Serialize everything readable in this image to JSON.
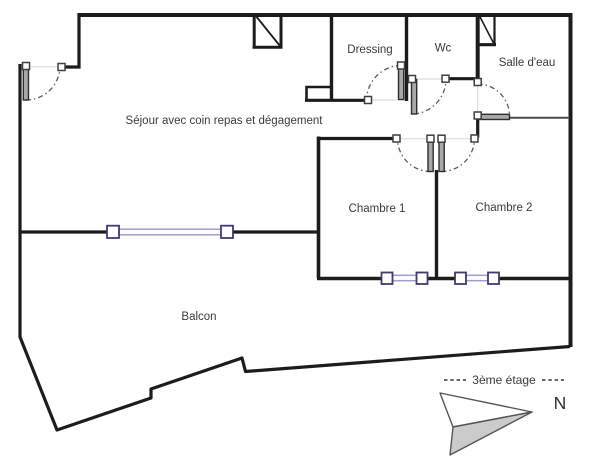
{
  "labels": {
    "sejour": "Séjour avec coin repas et dégagement",
    "dressing": "Dressing",
    "wc": "Wc",
    "salle_deau": "Salle d'eau",
    "chambre1": "Chambre 1",
    "chambre2": "Chambre 2",
    "balcon": "Balcon",
    "floor": "3ème étage",
    "north": "N"
  },
  "colors": {
    "wall": "#1c1c1c",
    "interior_thin_wall": "#4a4a4a",
    "door_leaf": "#a8a8a8",
    "door_swing_arc": "#5a5a5a",
    "window_frame": "#3d3d70",
    "window_bar": "#9e9ecf",
    "compass_fill": "#cbcbcb",
    "label_text": "#3a3a3a",
    "background": "#ffffff"
  }
}
